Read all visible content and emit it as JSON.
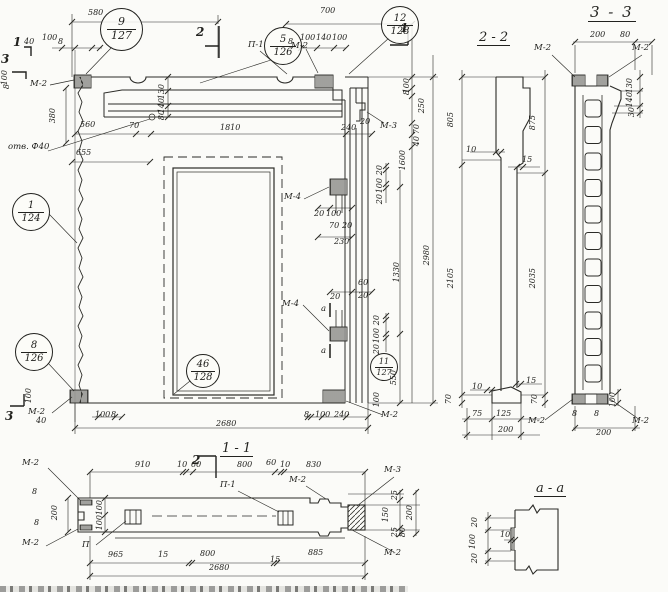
{
  "meta": {
    "drawing_type": "precast reinforced-concrete wall panel working drawing",
    "language": "ru"
  },
  "titles": {
    "s22": "2 - 2",
    "s33": "3 - 3",
    "s11": "1 - 1",
    "saa": "а - а"
  },
  "callouts": [
    {
      "num": "9",
      "sheet": "127",
      "x": 100,
      "y": 8,
      "d": 43,
      "fs": 11
    },
    {
      "num": "5",
      "sheet": "126",
      "x": 264,
      "y": 27,
      "d": 38,
      "fs": 10
    },
    {
      "num": "12",
      "sheet": "128",
      "x": 381,
      "y": 6,
      "d": 38,
      "fs": 10
    },
    {
      "num": "1",
      "sheet": "124",
      "x": 12,
      "y": 193,
      "d": 38,
      "fs": 10
    },
    {
      "num": "8",
      "sheet": "126",
      "x": 15,
      "y": 333,
      "d": 38,
      "fs": 10
    },
    {
      "num": "46",
      "sheet": "128",
      "x": 186,
      "y": 354,
      "d": 34,
      "fs": 10
    },
    {
      "num": "11",
      "sheet": "127",
      "x": 370,
      "y": 353,
      "d": 28,
      "fs": 8
    }
  ],
  "labels": [
    {
      "t": "М-2",
      "x": 30,
      "y": 80
    },
    {
      "t": "П-1",
      "x": 248,
      "y": 41
    },
    {
      "t": "М-2",
      "x": 291,
      "y": 42
    },
    {
      "t": "М-3",
      "x": 380,
      "y": 122
    },
    {
      "t": "отв. Ф40",
      "x": 8,
      "y": 143
    },
    {
      "t": "М-4",
      "x": 284,
      "y": 193
    },
    {
      "t": "М-4",
      "x": 282,
      "y": 300
    },
    {
      "t": "а",
      "x": 321,
      "y": 305
    },
    {
      "t": "а",
      "x": 321,
      "y": 347
    },
    {
      "t": "М-2",
      "x": 28,
      "y": 408
    },
    {
      "t": "М-2",
      "x": 381,
      "y": 411
    },
    {
      "t": "М-2",
      "x": 22,
      "y": 459
    },
    {
      "t": "М-2",
      "x": 22,
      "y": 539
    },
    {
      "t": "П",
      "x": 82,
      "y": 541
    },
    {
      "t": "П-1",
      "x": 220,
      "y": 481
    },
    {
      "t": "М-2",
      "x": 289,
      "y": 476
    },
    {
      "t": "М-3",
      "x": 384,
      "y": 466
    },
    {
      "t": "М-2",
      "x": 384,
      "y": 549
    },
    {
      "t": "М-2",
      "x": 534,
      "y": 44
    },
    {
      "t": "М-2",
      "x": 632,
      "y": 44
    },
    {
      "t": "М-2",
      "x": 528,
      "y": 417
    },
    {
      "t": "М-2",
      "x": 632,
      "y": 417
    }
  ],
  "marks": [
    {
      "t": "1",
      "x": 13,
      "y": 36
    },
    {
      "t": "3",
      "x": 1,
      "y": 53
    },
    {
      "t": "2",
      "x": 196,
      "y": 26
    },
    {
      "t": "1",
      "x": 400,
      "y": 22
    },
    {
      "t": "3",
      "x": 5,
      "y": 410
    },
    {
      "t": "2",
      "x": 192,
      "y": 454
    }
  ],
  "dims": [
    {
      "t": "580",
      "x": 88,
      "y": 9
    },
    {
      "t": "700",
      "x": 320,
      "y": 7
    },
    {
      "t": "40",
      "x": 24,
      "y": 38
    },
    {
      "t": "100",
      "x": 42,
      "y": 34
    },
    {
      "t": "8",
      "x": 58,
      "y": 38
    },
    {
      "t": "8",
      "x": 288,
      "y": 38
    },
    {
      "t": "100",
      "x": 300,
      "y": 34
    },
    {
      "t": "140",
      "x": 316,
      "y": 34
    },
    {
      "t": "100",
      "x": 332,
      "y": 34
    },
    {
      "t": "100",
      "x": 1,
      "y": 70,
      "r": 1
    },
    {
      "t": "8",
      "x": 3,
      "y": 84,
      "r": 1
    },
    {
      "t": "380",
      "x": 49,
      "y": 108,
      "r": 1
    },
    {
      "t": "130",
      "x": 158,
      "y": 84,
      "r": 1
    },
    {
      "t": "140",
      "x": 158,
      "y": 98,
      "r": 1
    },
    {
      "t": "80",
      "x": 158,
      "y": 110,
      "r": 1
    },
    {
      "t": "560",
      "x": 80,
      "y": 121
    },
    {
      "t": "70",
      "x": 129,
      "y": 122
    },
    {
      "t": "655",
      "x": 76,
      "y": 149
    },
    {
      "t": "1810",
      "x": 220,
      "y": 124
    },
    {
      "t": "240",
      "x": 341,
      "y": 124
    },
    {
      "t": "100",
      "x": 403,
      "y": 78,
      "r": 1
    },
    {
      "t": "8",
      "x": 403,
      "y": 90,
      "r": 1
    },
    {
      "t": "250",
      "x": 418,
      "y": 98,
      "r": 1
    },
    {
      "t": "70",
      "x": 413,
      "y": 124,
      "r": 1
    },
    {
      "t": "40",
      "x": 413,
      "y": 136,
      "r": 1
    },
    {
      "t": "20",
      "x": 360,
      "y": 118
    },
    {
      "t": "1600",
      "x": 399,
      "y": 150,
      "r": 1
    },
    {
      "t": "2980",
      "x": 423,
      "y": 245,
      "r": 1
    },
    {
      "t": "1330",
      "x": 393,
      "y": 262,
      "r": 1
    },
    {
      "t": "550",
      "x": 390,
      "y": 370,
      "r": 1
    },
    {
      "t": "20",
      "x": 376,
      "y": 165,
      "r": 1
    },
    {
      "t": "100",
      "x": 376,
      "y": 178,
      "r": 1
    },
    {
      "t": "20",
      "x": 376,
      "y": 194,
      "r": 1
    },
    {
      "t": "20",
      "x": 314,
      "y": 210
    },
    {
      "t": "100",
      "x": 326,
      "y": 210
    },
    {
      "t": "70",
      "x": 329,
      "y": 222
    },
    {
      "t": "20",
      "x": 342,
      "y": 222
    },
    {
      "t": "230",
      "x": 334,
      "y": 238
    },
    {
      "t": "60",
      "x": 358,
      "y": 279
    },
    {
      "t": "20",
      "x": 330,
      "y": 293
    },
    {
      "t": "20",
      "x": 358,
      "y": 292
    },
    {
      "t": "20",
      "x": 373,
      "y": 315,
      "r": 1
    },
    {
      "t": "100",
      "x": 373,
      "y": 328,
      "r": 1
    },
    {
      "t": "20",
      "x": 373,
      "y": 344,
      "r": 1
    },
    {
      "t": "100",
      "x": 373,
      "y": 392,
      "r": 1
    },
    {
      "t": "100",
      "x": 25,
      "y": 388,
      "r": 1
    },
    {
      "t": "100",
      "x": 95,
      "y": 411
    },
    {
      "t": "8",
      "x": 111,
      "y": 411
    },
    {
      "t": "40",
      "x": 36,
      "y": 417
    },
    {
      "t": "8",
      "x": 304,
      "y": 411
    },
    {
      "t": "100",
      "x": 315,
      "y": 411
    },
    {
      "t": "240",
      "x": 334,
      "y": 411
    },
    {
      "t": "2680",
      "x": 216,
      "y": 420
    },
    {
      "t": "910",
      "x": 135,
      "y": 461
    },
    {
      "t": "10",
      "x": 177,
      "y": 461
    },
    {
      "t": "60",
      "x": 191,
      "y": 461
    },
    {
      "t": "800",
      "x": 237,
      "y": 461
    },
    {
      "t": "60",
      "x": 266,
      "y": 459
    },
    {
      "t": "10",
      "x": 280,
      "y": 461
    },
    {
      "t": "830",
      "x": 306,
      "y": 461
    },
    {
      "t": "8",
      "x": 32,
      "y": 488
    },
    {
      "t": "8",
      "x": 34,
      "y": 519
    },
    {
      "t": "200",
      "x": 51,
      "y": 505,
      "r": 1
    },
    {
      "t": "100",
      "x": 96,
      "y": 500,
      "r": 1
    },
    {
      "t": "100",
      "x": 96,
      "y": 515,
      "r": 1
    },
    {
      "t": "25",
      "x": 391,
      "y": 490,
      "r": 1
    },
    {
      "t": "150",
      "x": 382,
      "y": 507,
      "r": 1
    },
    {
      "t": "25",
      "x": 391,
      "y": 527,
      "r": 1
    },
    {
      "t": "200",
      "x": 406,
      "y": 505,
      "r": 1
    },
    {
      "t": "80",
      "x": 399,
      "y": 527,
      "r": 1
    },
    {
      "t": "965",
      "x": 108,
      "y": 551
    },
    {
      "t": "15",
      "x": 158,
      "y": 551
    },
    {
      "t": "800",
      "x": 200,
      "y": 550
    },
    {
      "t": "15",
      "x": 270,
      "y": 556
    },
    {
      "t": "885",
      "x": 308,
      "y": 549
    },
    {
      "t": "2680",
      "x": 209,
      "y": 564
    },
    {
      "t": "805",
      "x": 447,
      "y": 112,
      "r": 1
    },
    {
      "t": "2105",
      "x": 447,
      "y": 268,
      "r": 1
    },
    {
      "t": "70",
      "x": 445,
      "y": 394,
      "r": 1
    },
    {
      "t": "10",
      "x": 466,
      "y": 146
    },
    {
      "t": "15",
      "x": 522,
      "y": 156
    },
    {
      "t": "875",
      "x": 529,
      "y": 115,
      "r": 1
    },
    {
      "t": "2035",
      "x": 529,
      "y": 268,
      "r": 1
    },
    {
      "t": "10",
      "x": 472,
      "y": 383
    },
    {
      "t": "15",
      "x": 526,
      "y": 377
    },
    {
      "t": "70",
      "x": 531,
      "y": 394,
      "r": 1
    },
    {
      "t": "75",
      "x": 472,
      "y": 410
    },
    {
      "t": "125",
      "x": 496,
      "y": 410
    },
    {
      "t": "200",
      "x": 498,
      "y": 426
    },
    {
      "t": "200",
      "x": 590,
      "y": 31
    },
    {
      "t": "80",
      "x": 620,
      "y": 31
    },
    {
      "t": "130",
      "x": 626,
      "y": 78,
      "r": 1
    },
    {
      "t": "140",
      "x": 626,
      "y": 92,
      "r": 1
    },
    {
      "t": "30",
      "x": 628,
      "y": 107,
      "r": 1
    },
    {
      "t": "8",
      "x": 572,
      "y": 410
    },
    {
      "t": "8",
      "x": 594,
      "y": 410
    },
    {
      "t": "100",
      "x": 609,
      "y": 392,
      "r": 1
    },
    {
      "t": "200",
      "x": 596,
      "y": 429
    },
    {
      "t": "20",
      "x": 471,
      "y": 517,
      "r": 1
    },
    {
      "t": "100",
      "x": 469,
      "y": 534,
      "r": 1
    },
    {
      "t": "20",
      "x": 471,
      "y": 553,
      "r": 1
    },
    {
      "t": "10",
      "x": 500,
      "y": 531
    }
  ]
}
